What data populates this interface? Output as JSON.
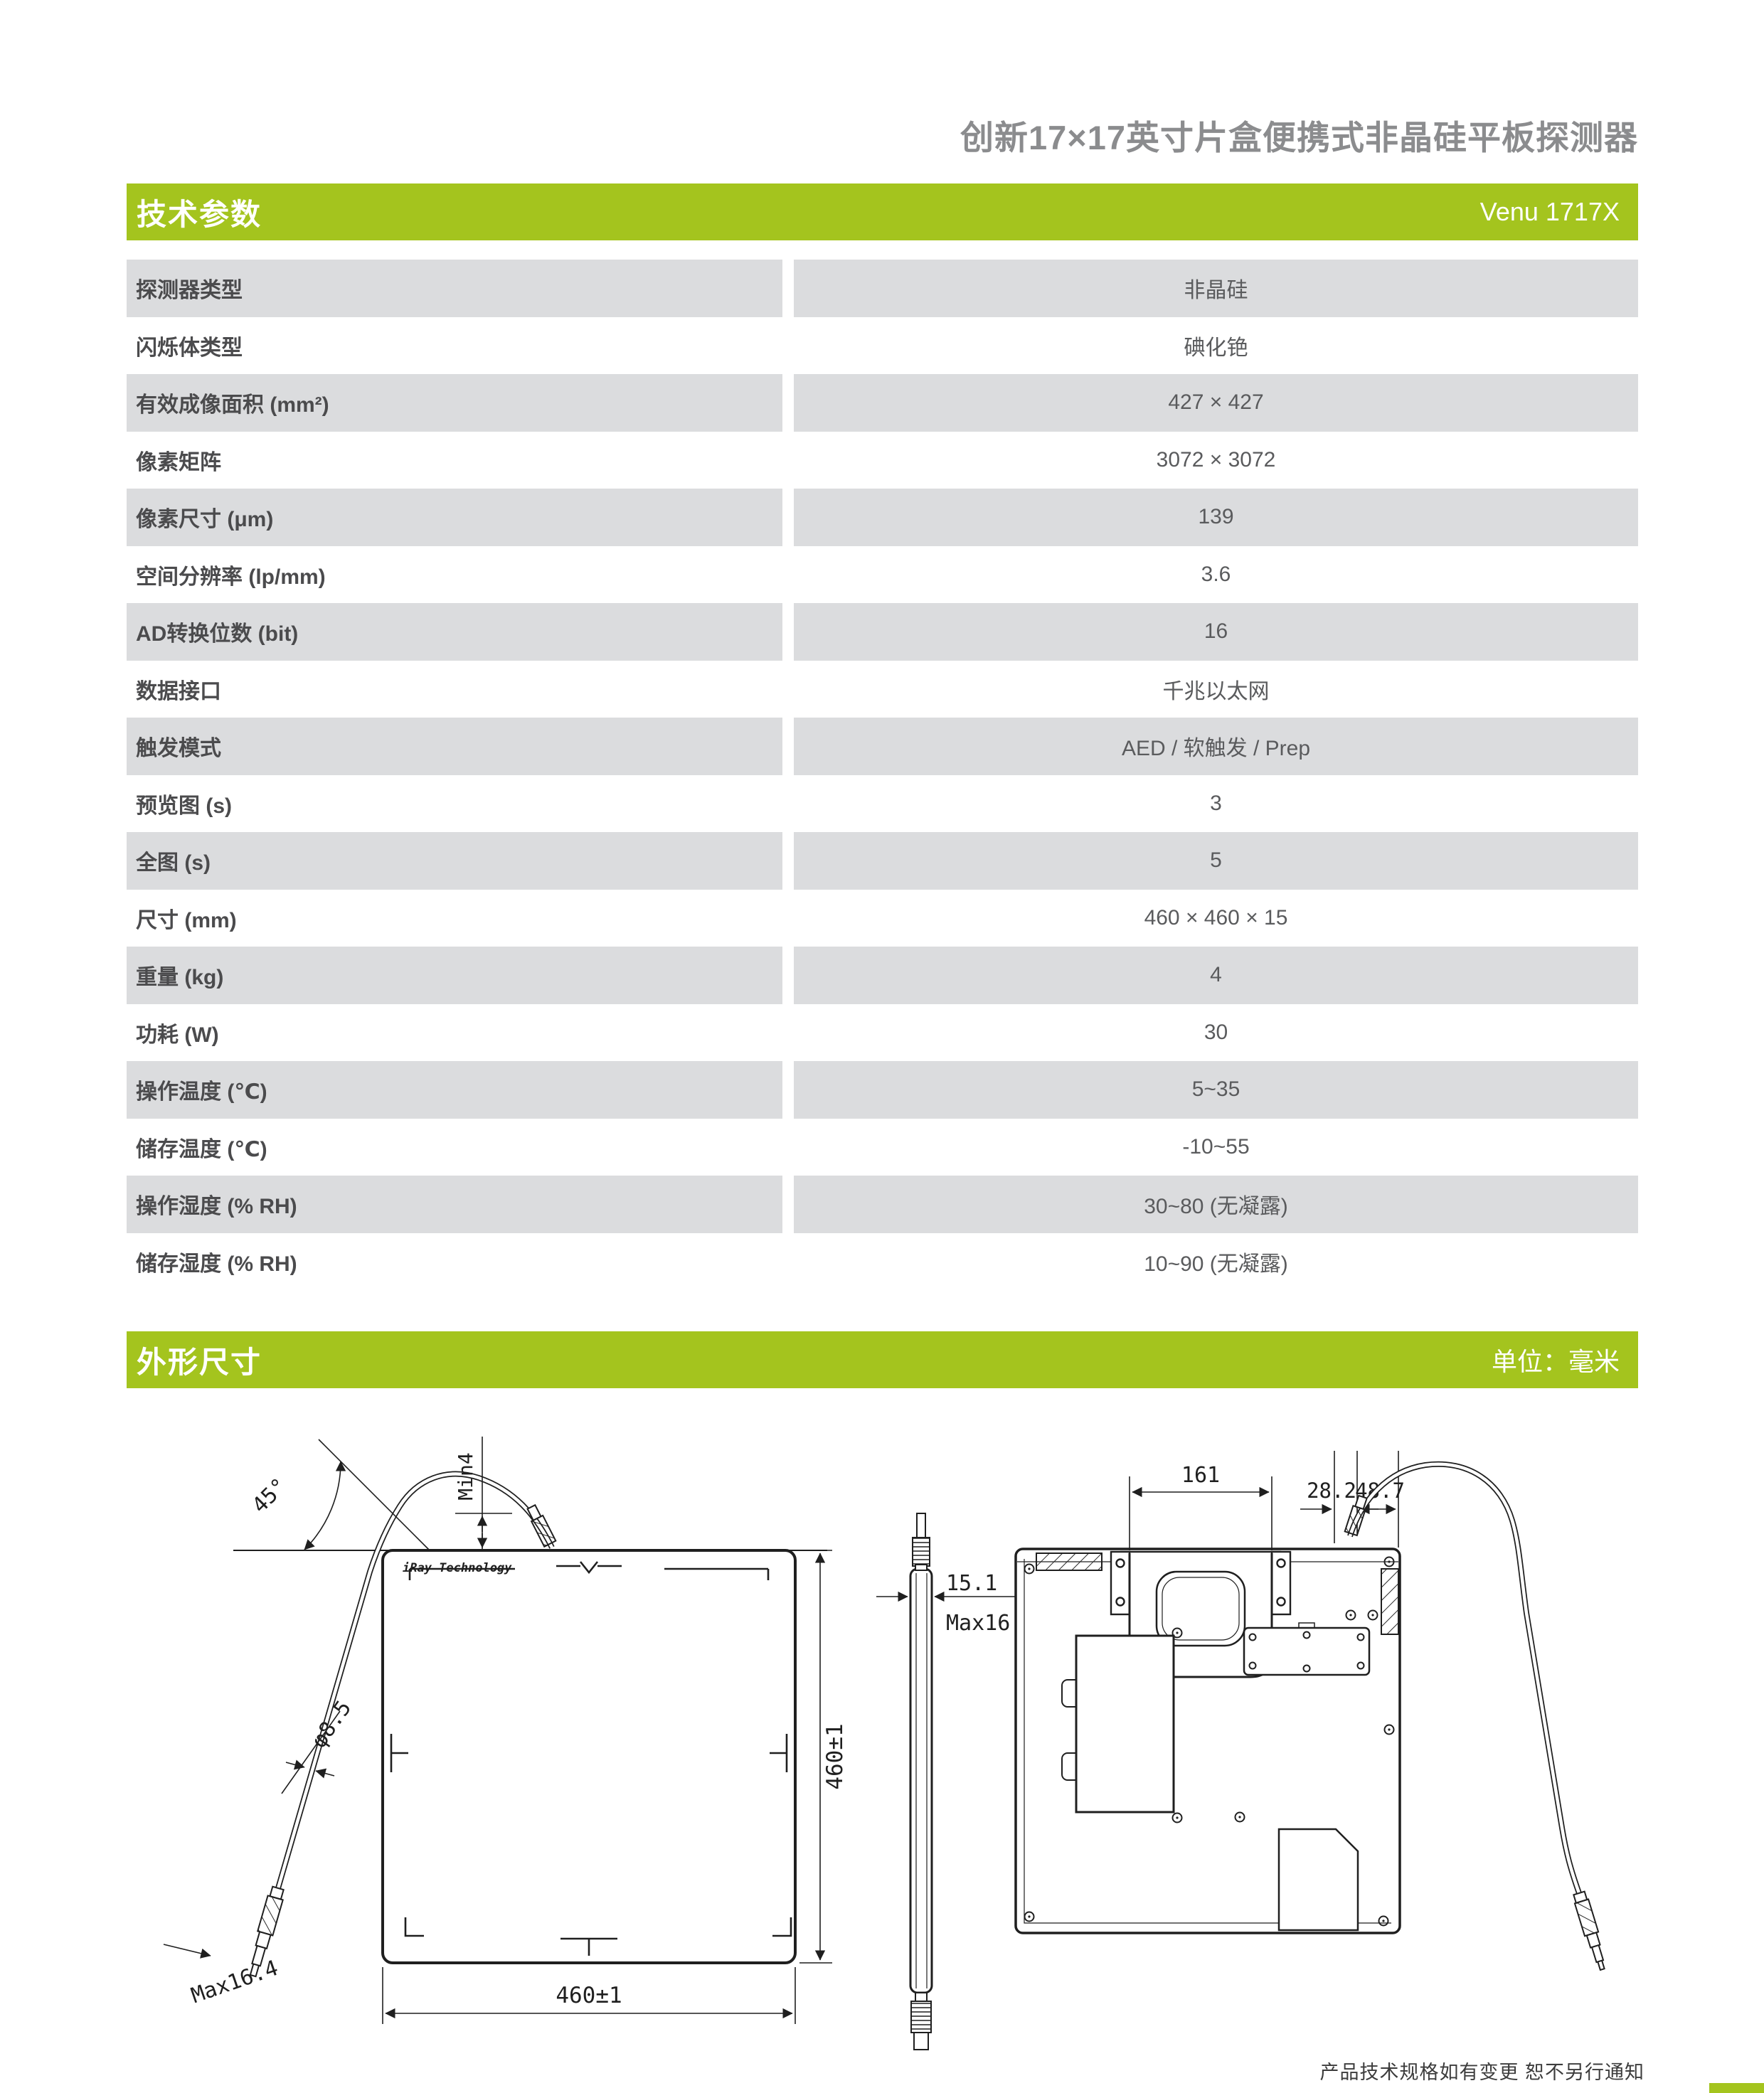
{
  "page": {
    "title": "创新17×17英寸片盒便携式非晶硅平板探测器",
    "footer_note": "产品技术规格如有变更  恕不另行通知"
  },
  "colors": {
    "accent_green": "#a4c41e",
    "row_gray": "#dbdcde",
    "label_text": "#4b4b4d",
    "value_text": "#5a5b5d",
    "title_text": "#8b8c8e"
  },
  "sections": {
    "tech": {
      "title": "技术参数",
      "model": "Venu 1717X"
    },
    "outline": {
      "title": "外形尺寸",
      "unit": "单位：毫米"
    }
  },
  "spec_table": {
    "rows": [
      {
        "label": "探测器类型",
        "value": "非晶硅"
      },
      {
        "label": "闪烁体类型",
        "value": "碘化铯"
      },
      {
        "label": "有效成像面积 (mm²)",
        "value": "427 × 427"
      },
      {
        "label": "像素矩阵",
        "value": "3072 × 3072"
      },
      {
        "label": "像素尺寸 (μm)",
        "value": "139"
      },
      {
        "label": "空间分辨率 (lp/mm)",
        "value": "3.6"
      },
      {
        "label": "AD转换位数 (bit)",
        "value": "16"
      },
      {
        "label": "数据接口",
        "value": "千兆以太网"
      },
      {
        "label": "触发模式",
        "value": "AED / 软触发 / Prep"
      },
      {
        "label": "预览图 (s)",
        "value": "3"
      },
      {
        "label": "全图 (s)",
        "value": "5"
      },
      {
        "label": "尺寸 (mm)",
        "value": "460 × 460 × 15"
      },
      {
        "label": "重量 (kg)",
        "value": "4"
      },
      {
        "label": "功耗 (W)",
        "value": "30"
      },
      {
        "label": "操作温度 (℃)",
        "value": "5~35"
      },
      {
        "label": "储存温度 (℃)",
        "value": "-10~55"
      },
      {
        "label": "操作湿度 (% RH)",
        "value": "30~80 (无凝露)"
      },
      {
        "label": "储存湿度 (% RH)",
        "value": "10~90 (无凝露)"
      }
    ]
  },
  "drawing": {
    "front": {
      "logo": "iRay Technology",
      "angle_label": "45°",
      "min_label": "Min4",
      "dia_label": "φ8.5",
      "max_label": "Max16.4",
      "width_label": "460±1",
      "height_label": "460±1"
    },
    "side": {
      "thickness_label": "15.1",
      "max_label": "Max16.0"
    },
    "back": {
      "handle_label": "161",
      "offset_left_label": "28.2",
      "offset_right_label": "48.7"
    }
  }
}
